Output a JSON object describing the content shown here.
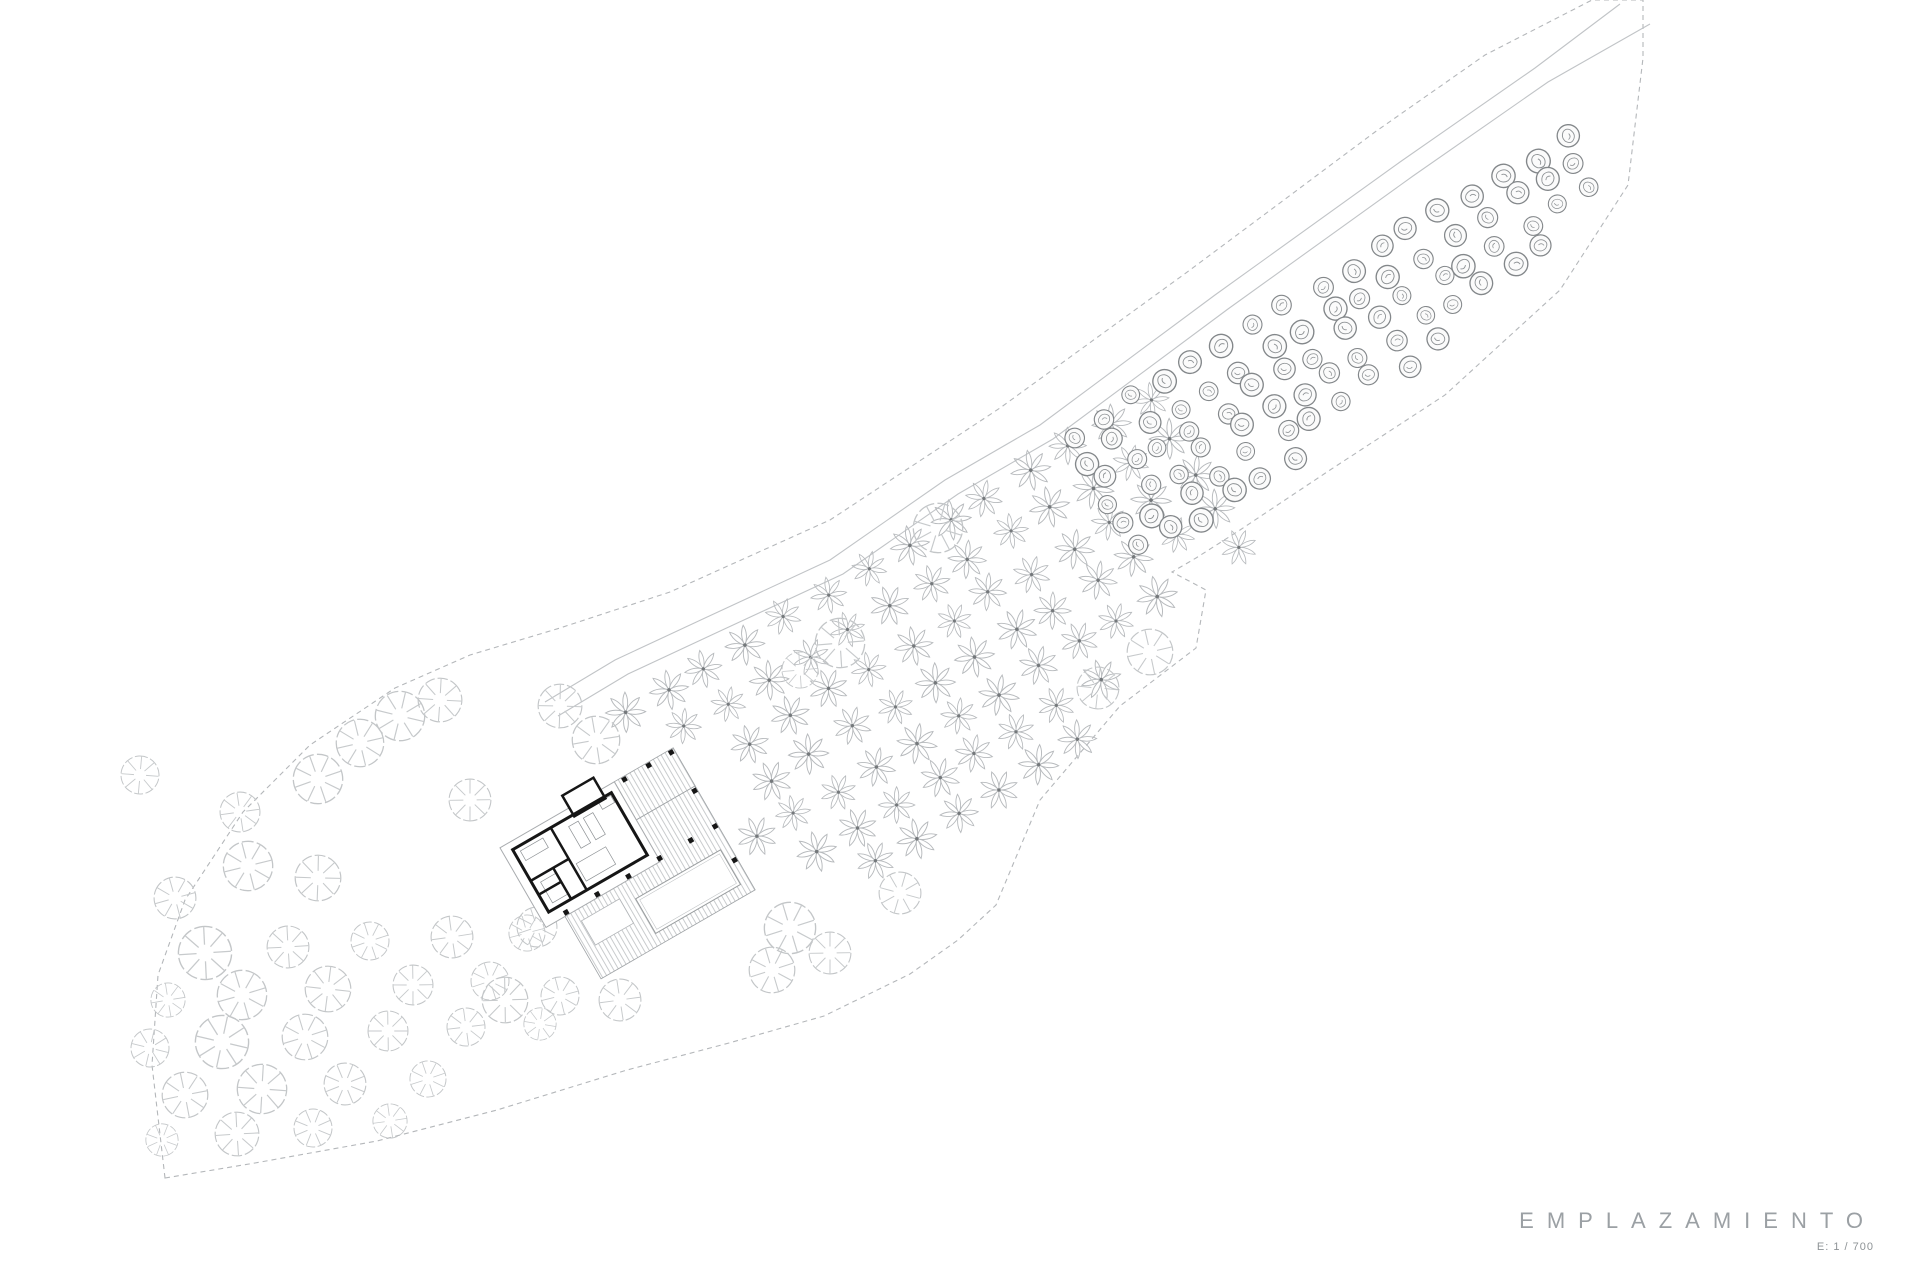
{
  "title_block": {
    "title": "EMPLAZAMIENTO",
    "scale_label": "E: 1 / 700"
  },
  "colors": {
    "background": "#ffffff",
    "boundary_line": "#b4b7ba",
    "road_line": "#c1c4c7",
    "light_tree": "#c3c6c8",
    "flower_tree": "#b7babd",
    "flower_center": "#74787b",
    "dark_tree": "#83878a",
    "wall": "#161616",
    "deck_hatch": "#c3c6c8"
  },
  "site": {
    "boundary_points": [
      [
        165,
        1178
      ],
      [
        152,
        1065
      ],
      [
        158,
        975
      ],
      [
        185,
        900
      ],
      [
        243,
        812
      ],
      [
        310,
        745
      ],
      [
        395,
        688
      ],
      [
        470,
        655
      ],
      [
        560,
        628
      ],
      [
        670,
        592
      ],
      [
        830,
        520
      ],
      [
        1000,
        408
      ],
      [
        1190,
        270
      ],
      [
        1375,
        132
      ],
      [
        1485,
        55
      ],
      [
        1592,
        0
      ],
      [
        1643,
        0
      ],
      [
        1643,
        58
      ],
      [
        1628,
        185
      ],
      [
        1560,
        290
      ],
      [
        1445,
        395
      ],
      [
        1330,
        470
      ],
      [
        1240,
        530
      ],
      [
        1196,
        558
      ],
      [
        1172,
        572
      ],
      [
        1206,
        590
      ],
      [
        1196,
        648
      ],
      [
        1120,
        706
      ],
      [
        1040,
        800
      ],
      [
        996,
        905
      ],
      [
        958,
        940
      ],
      [
        910,
        974
      ],
      [
        824,
        1016
      ],
      [
        729,
        1043
      ],
      [
        627,
        1070
      ],
      [
        497,
        1110
      ],
      [
        377,
        1141
      ],
      [
        255,
        1163
      ]
    ],
    "road_lines": [
      [
        [
          545,
          702
        ],
        [
          615,
          660
        ],
        [
          705,
          618
        ],
        [
          830,
          560
        ],
        [
          945,
          480
        ],
        [
          1040,
          425
        ],
        [
          1215,
          295
        ],
        [
          1400,
          162
        ],
        [
          1535,
          68
        ],
        [
          1620,
          4
        ]
      ],
      [
        [
          558,
          716
        ],
        [
          628,
          674
        ],
        [
          718,
          632
        ],
        [
          843,
          574
        ],
        [
          958,
          494
        ],
        [
          1053,
          439
        ],
        [
          1228,
          309
        ],
        [
          1413,
          176
        ],
        [
          1548,
          82
        ],
        [
          1650,
          24
        ]
      ]
    ]
  },
  "groves": {
    "flower_grid": {
      "symbol": "flower-tree",
      "origin": [
        625,
        715
      ],
      "angle_deg": -31,
      "cols": 14,
      "col_step": 47,
      "rows": 7,
      "row_step": 43,
      "jitter": 4,
      "scale_min": 0.92,
      "scale_max": 1.08,
      "max_y": 870,
      "exclude_rect": [
        470,
        740,
        735,
        965
      ],
      "clip_line_right": [
        [
          1196,
          558
        ],
        [
          996,
          905
        ]
      ],
      "road_offset": 8
    },
    "dark_grid": {
      "symbol": "dark-tree",
      "origin": [
        1072,
        436
      ],
      "angle_deg": -31,
      "cols": 17,
      "col_step": 36,
      "rows": 6,
      "row_step": 27,
      "jitter": 7,
      "scale_min": 0.85,
      "scale_max": 1.15,
      "x_max": 1622,
      "y_min": 4,
      "clip_line_right": [
        [
          1628,
          185
        ],
        [
          1196,
          558
        ]
      ],
      "road_offset": 6
    }
  },
  "scattered_trees": [
    [
      318,
      779,
      26
    ],
    [
      360,
      743,
      25
    ],
    [
      400,
      716,
      26
    ],
    [
      440,
      700,
      23
    ],
    [
      470,
      800,
      22
    ],
    [
      560,
      706,
      23
    ],
    [
      596,
      740,
      25
    ],
    [
      140,
      775,
      20
    ],
    [
      240,
      812,
      21
    ],
    [
      175,
      898,
      22
    ],
    [
      248,
      866,
      26
    ],
    [
      318,
      878,
      24
    ],
    [
      205,
      953,
      28
    ],
    [
      288,
      947,
      22
    ],
    [
      370,
      941,
      20
    ],
    [
      452,
      937,
      22
    ],
    [
      527,
      933,
      19
    ],
    [
      168,
      1000,
      18
    ],
    [
      242,
      995,
      26
    ],
    [
      328,
      989,
      24
    ],
    [
      413,
      985,
      21
    ],
    [
      490,
      981,
      20
    ],
    [
      150,
      1048,
      20
    ],
    [
      222,
      1042,
      28
    ],
    [
      305,
      1037,
      24
    ],
    [
      388,
      1031,
      21
    ],
    [
      466,
      1027,
      20
    ],
    [
      540,
      1024,
      17
    ],
    [
      185,
      1095,
      24
    ],
    [
      262,
      1089,
      26
    ],
    [
      345,
      1084,
      22
    ],
    [
      428,
      1079,
      19
    ],
    [
      162,
      1140,
      17
    ],
    [
      237,
      1134,
      23
    ],
    [
      313,
      1128,
      20
    ],
    [
      390,
      1121,
      18
    ],
    [
      505,
      1000,
      24
    ],
    [
      560,
      996,
      20
    ],
    [
      620,
      1000,
      22
    ],
    [
      537,
      927,
      21
    ],
    [
      790,
      928,
      27
    ],
    [
      830,
      953,
      22
    ],
    [
      772,
      970,
      24
    ],
    [
      900,
      893,
      22
    ],
    [
      840,
      643,
      26
    ],
    [
      800,
      670,
      19
    ],
    [
      938,
      528,
      26
    ],
    [
      1150,
      652,
      24
    ],
    [
      1098,
      688,
      22
    ]
  ],
  "building": {
    "center": [
      600,
      857
    ],
    "rotation_deg": -30,
    "deck_rects": [
      [
        -60,
        -14,
        178,
        120
      ],
      [
        50,
        -58,
        68,
        44
      ]
    ],
    "steps_rect": [
      -48,
      46,
      44,
      28
    ],
    "pool_rect": [
      10,
      54,
      98,
      40
    ],
    "platform_rect": [
      -82,
      -58,
      132,
      92
    ],
    "outer_wall_rect": [
      -72,
      -50,
      114,
      72
    ],
    "small_room_rect": [
      -2,
      -72,
      36,
      24
    ],
    "inner_walls": [
      [
        -28,
        -50,
        -28,
        22
      ],
      [
        -72,
        -14,
        -28,
        -14
      ],
      [
        -46,
        -14,
        -46,
        22
      ],
      [
        -72,
        2,
        -46,
        2
      ]
    ],
    "columns": [
      [
        -57,
        31
      ],
      [
        -21,
        31
      ],
      [
        15,
        31
      ],
      [
        51,
        31
      ],
      [
        87,
        31
      ],
      [
        115,
        31
      ],
      [
        115,
        -10
      ],
      [
        115,
        70
      ],
      [
        60,
        -55
      ],
      [
        88,
        -55
      ],
      [
        114,
        -55
      ]
    ],
    "furniture": [
      [
        -66,
        -45,
        26,
        11
      ],
      [
        -12,
        -42,
        11,
        25
      ],
      [
        5,
        -42,
        11,
        25
      ],
      [
        -64,
        -8,
        18,
        24
      ],
      [
        -24,
        -6,
        34,
        20
      ],
      [
        26,
        -48,
        14,
        8
      ]
    ]
  }
}
